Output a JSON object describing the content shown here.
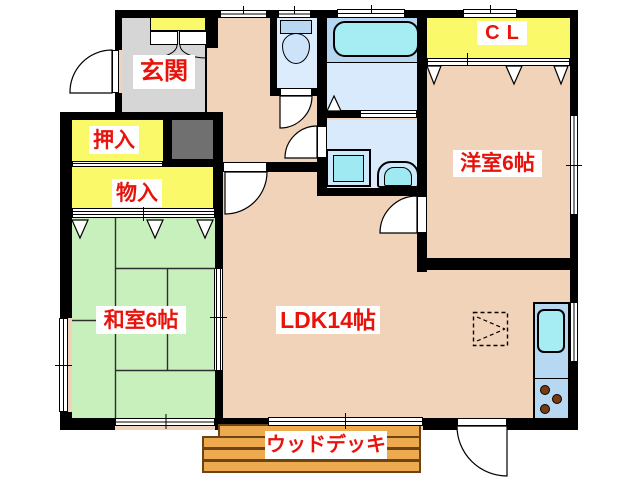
{
  "plan": {
    "title": "2LDK floor plan",
    "labels": {
      "genkan": "玄関",
      "oshiire": "押入",
      "monoire": "物入",
      "washitsu": "和室6帖",
      "ldk": "LDK14帖",
      "yoshitsu": "洋室6帖",
      "closet": "CL",
      "wooddeck": "ウッドデッキ"
    },
    "fixtures": [
      "bathtub",
      "toilet",
      "washing-machine",
      "vanity-sink",
      "kitchen-sink",
      "stove-burners",
      "shoe-cabinet",
      "floor-hatch",
      "wood-deck"
    ],
    "colors": {
      "wall": "#000000",
      "room_pink": "#f1d3ba",
      "tatami_green": "#c8f0bd",
      "storage_yellow": "#f9f96a",
      "genkan_gray": "#d6d6d6",
      "cabinet_gray": "#707070",
      "wet_floor_blue": "#d9eafc",
      "bath_zone_blue": "#b5d7f2",
      "fixture_cyan": "#a5edf2",
      "kitchen_counter_blue": "#b7d8f3",
      "deck_orange": "#edaa4e",
      "label_red": "#e8140c"
    }
  }
}
